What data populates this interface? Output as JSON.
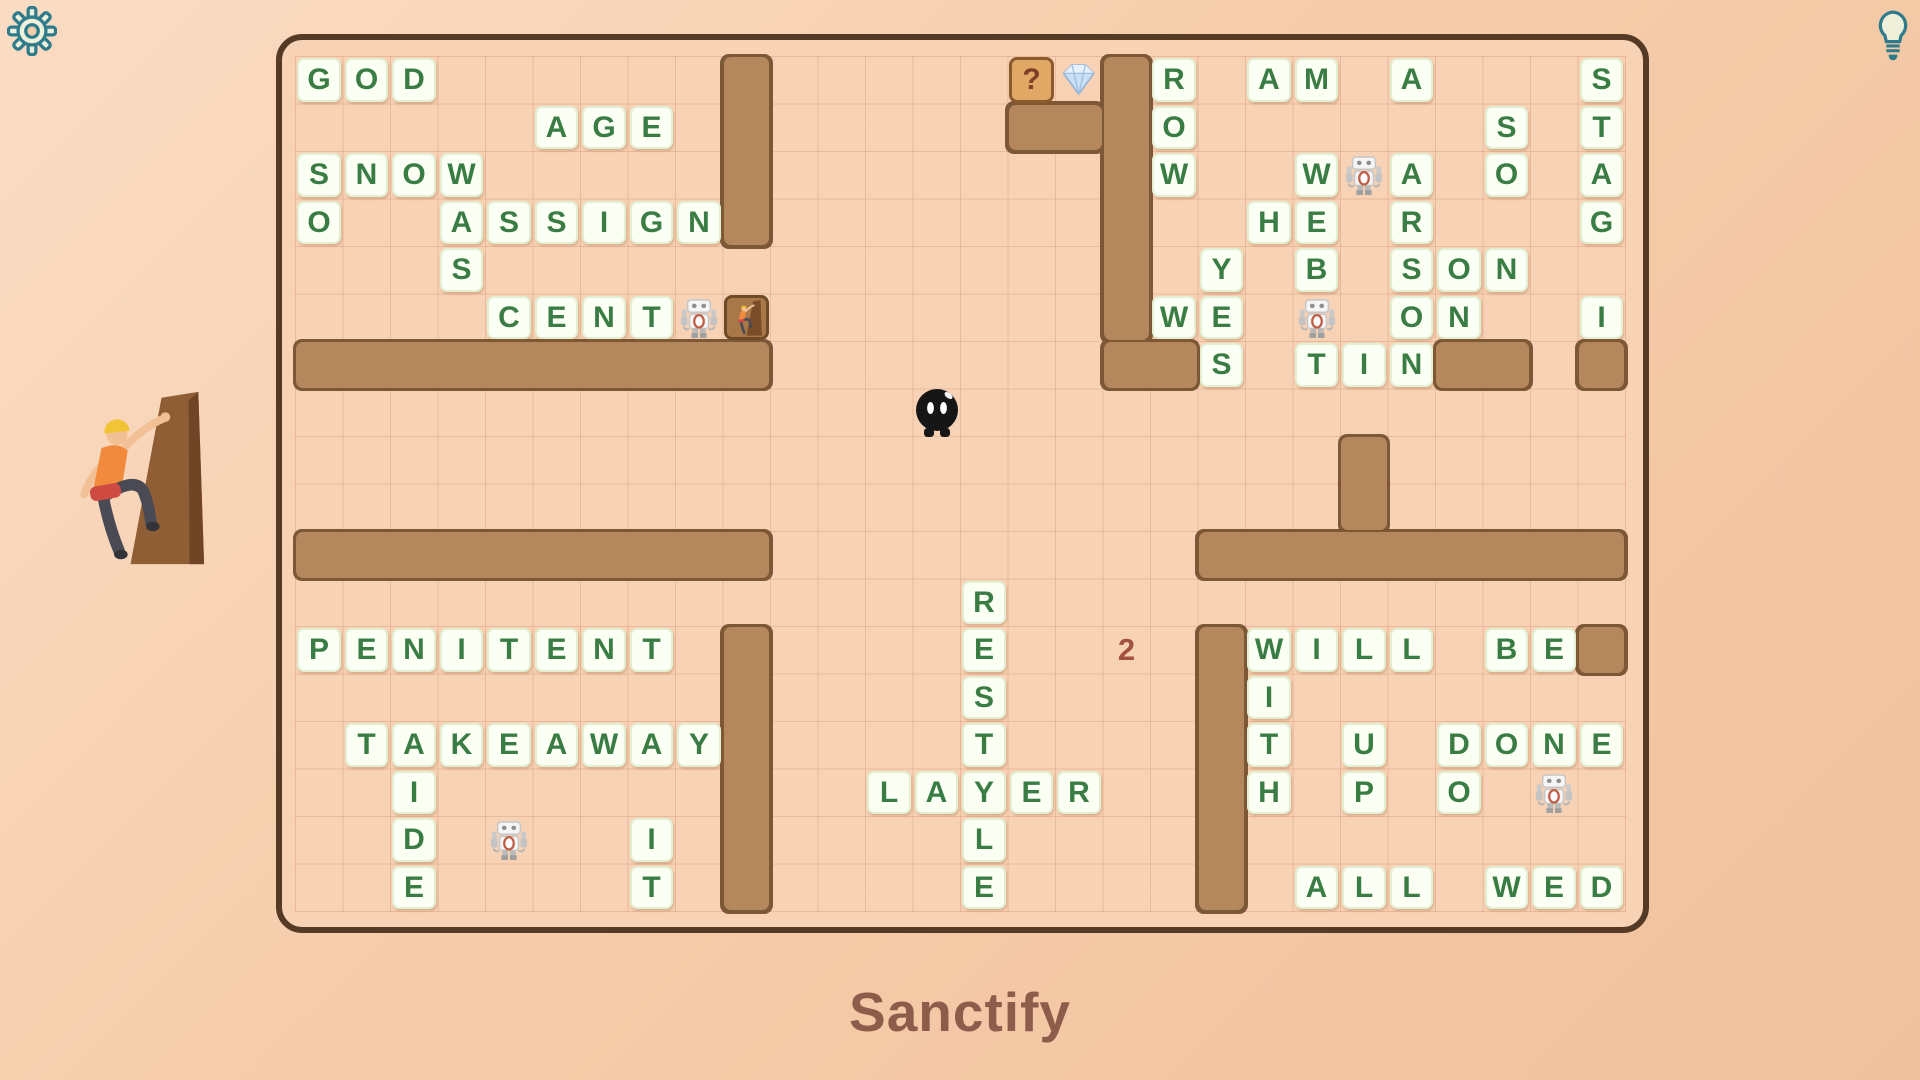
{
  "hud": {
    "word": "Sanctify",
    "counter": "2",
    "settings_icon": "gear-icon",
    "hint_icon": "lightbulb-icon"
  },
  "colors": {
    "board_bg": "#f8d2b4",
    "board_border": "#553b26",
    "wall_fill": "#b5875c",
    "wall_border": "#7d5836",
    "letter": "#3a7d44",
    "question_fill": "#e0a765",
    "counter": "#a35242",
    "title": "#8d5c4b",
    "accent_teal": "#2e7b8b"
  },
  "board": {
    "grid": {
      "cols": 28,
      "rows": 18
    },
    "tiles": [
      [
        0,
        0,
        "G"
      ],
      [
        1,
        0,
        "O"
      ],
      [
        2,
        0,
        "D"
      ],
      [
        5,
        1,
        "A"
      ],
      [
        6,
        1,
        "G"
      ],
      [
        7,
        1,
        "E"
      ],
      [
        0,
        2,
        "S"
      ],
      [
        1,
        2,
        "N"
      ],
      [
        2,
        2,
        "O"
      ],
      [
        3,
        2,
        "W"
      ],
      [
        0,
        3,
        "O"
      ],
      [
        3,
        3,
        "A"
      ],
      [
        4,
        3,
        "S"
      ],
      [
        5,
        3,
        "S"
      ],
      [
        6,
        3,
        "I"
      ],
      [
        7,
        3,
        "G"
      ],
      [
        8,
        3,
        "N"
      ],
      [
        3,
        4,
        "S"
      ],
      [
        4,
        5,
        "C"
      ],
      [
        5,
        5,
        "E"
      ],
      [
        6,
        5,
        "N"
      ],
      [
        7,
        5,
        "T"
      ],
      [
        18,
        0,
        "R"
      ],
      [
        20,
        0,
        "A"
      ],
      [
        21,
        0,
        "M"
      ],
      [
        23,
        0,
        "A"
      ],
      [
        27,
        0,
        "S"
      ],
      [
        18,
        1,
        "O"
      ],
      [
        25,
        1,
        "S"
      ],
      [
        27,
        1,
        "T"
      ],
      [
        18,
        2,
        "W"
      ],
      [
        21,
        2,
        "W"
      ],
      [
        23,
        2,
        "A"
      ],
      [
        25,
        2,
        "O"
      ],
      [
        27,
        2,
        "A"
      ],
      [
        20,
        3,
        "H"
      ],
      [
        21,
        3,
        "E"
      ],
      [
        23,
        3,
        "R"
      ],
      [
        27,
        3,
        "G"
      ],
      [
        19,
        4,
        "Y"
      ],
      [
        21,
        4,
        "B"
      ],
      [
        23,
        4,
        "S"
      ],
      [
        24,
        4,
        "O"
      ],
      [
        25,
        4,
        "N"
      ],
      [
        18,
        5,
        "W"
      ],
      [
        19,
        5,
        "E"
      ],
      [
        23,
        5,
        "O"
      ],
      [
        24,
        5,
        "N"
      ],
      [
        27,
        5,
        "I"
      ],
      [
        19,
        6,
        "S"
      ],
      [
        21,
        6,
        "T"
      ],
      [
        22,
        6,
        "I"
      ],
      [
        23,
        6,
        "N"
      ],
      [
        14,
        11,
        "R"
      ],
      [
        14,
        12,
        "E"
      ],
      [
        14,
        13,
        "S"
      ],
      [
        14,
        14,
        "T"
      ],
      [
        14,
        15,
        "Y"
      ],
      [
        14,
        16,
        "L"
      ],
      [
        14,
        17,
        "E"
      ],
      [
        12,
        15,
        "L"
      ],
      [
        13,
        15,
        "A"
      ],
      [
        15,
        15,
        "E"
      ],
      [
        16,
        15,
        "R"
      ],
      [
        0,
        12,
        "P"
      ],
      [
        1,
        12,
        "E"
      ],
      [
        2,
        12,
        "N"
      ],
      [
        3,
        12,
        "I"
      ],
      [
        4,
        12,
        "T"
      ],
      [
        5,
        12,
        "E"
      ],
      [
        6,
        12,
        "N"
      ],
      [
        7,
        12,
        "T"
      ],
      [
        1,
        14,
        "T"
      ],
      [
        2,
        14,
        "A"
      ],
      [
        3,
        14,
        "K"
      ],
      [
        4,
        14,
        "E"
      ],
      [
        5,
        14,
        "A"
      ],
      [
        6,
        14,
        "W"
      ],
      [
        7,
        14,
        "A"
      ],
      [
        8,
        14,
        "Y"
      ],
      [
        2,
        15,
        "I"
      ],
      [
        2,
        16,
        "D"
      ],
      [
        7,
        16,
        "I"
      ],
      [
        2,
        17,
        "E"
      ],
      [
        7,
        17,
        "T"
      ],
      [
        20,
        12,
        "W"
      ],
      [
        21,
        12,
        "I"
      ],
      [
        22,
        12,
        "L"
      ],
      [
        23,
        12,
        "L"
      ],
      [
        25,
        12,
        "B"
      ],
      [
        26,
        12,
        "E"
      ],
      [
        20,
        13,
        "I"
      ],
      [
        20,
        14,
        "T"
      ],
      [
        22,
        14,
        "U"
      ],
      [
        24,
        14,
        "D"
      ],
      [
        25,
        14,
        "O"
      ],
      [
        26,
        14,
        "N"
      ],
      [
        27,
        14,
        "E"
      ],
      [
        20,
        15,
        "H"
      ],
      [
        22,
        15,
        "P"
      ],
      [
        24,
        15,
        "O"
      ],
      [
        21,
        17,
        "A"
      ],
      [
        22,
        17,
        "L"
      ],
      [
        23,
        17,
        "L"
      ],
      [
        25,
        17,
        "W"
      ],
      [
        26,
        17,
        "E"
      ],
      [
        27,
        17,
        "D"
      ]
    ],
    "walls": [
      [
        9,
        0,
        1,
        4
      ],
      [
        17,
        0,
        1,
        6
      ],
      [
        15,
        1,
        2,
        1
      ],
      [
        17,
        6,
        2,
        1
      ],
      [
        0,
        6,
        10,
        1
      ],
      [
        0,
        10,
        10,
        1
      ],
      [
        9,
        12,
        1,
        6
      ],
      [
        22,
        8,
        1,
        2
      ],
      [
        19,
        10,
        9,
        1
      ],
      [
        19,
        12,
        1,
        6
      ],
      [
        24,
        6,
        2,
        1
      ],
      [
        27,
        6,
        1,
        1
      ],
      [
        27,
        12,
        1,
        1
      ]
    ],
    "question_tile": {
      "c": 15,
      "r": 0,
      "glyph": "?"
    },
    "diamond": {
      "c": 16,
      "r": 0
    },
    "door": {
      "c": 9,
      "r": 5
    },
    "robots": [
      [
        8,
        5
      ],
      [
        22,
        2
      ],
      [
        21,
        5
      ],
      [
        4,
        16
      ],
      [
        26,
        15
      ]
    ],
    "ball": {
      "c": 13,
      "r": 7
    },
    "counter_cell": {
      "c": 17,
      "r": 12
    },
    "words_visible": [
      "GOD",
      "AGE",
      "SNOW",
      "SO",
      "WAS",
      "ASSIGN",
      "CENT",
      "AM",
      "ROW",
      "STAG",
      "WEB",
      "HE",
      "ARSON",
      "SON",
      "YES",
      "WE",
      "ON",
      "TIN",
      "PENITENT",
      "TAKEAWAY",
      "AIDE",
      "IT",
      "RESTYLE",
      "LAYER",
      "WILL",
      "BE",
      "WITH",
      "UP",
      "DONE",
      "DO",
      "ALL",
      "WED"
    ]
  }
}
